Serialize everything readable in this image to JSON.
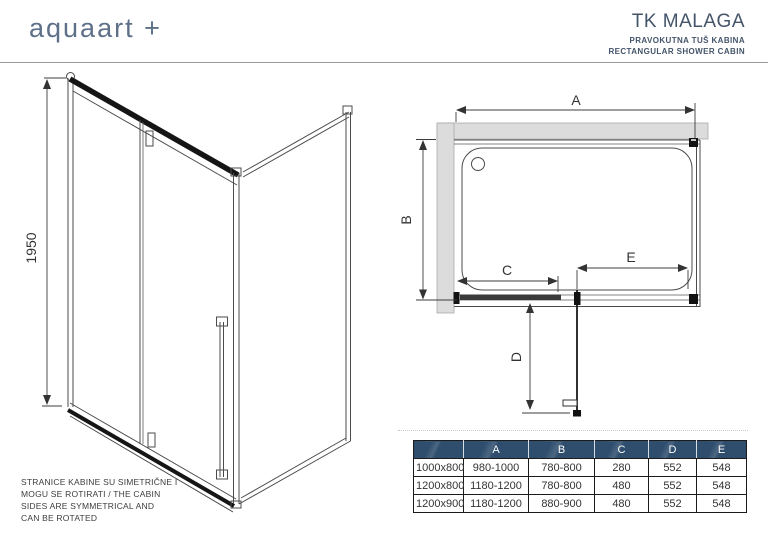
{
  "header": {
    "logo": "aquaart +",
    "product_name": "TK MALAGA",
    "subtitle_hr": "PRAVOKUTNA TUŠ KABINA",
    "subtitle_en": "RECTANGULAR SHOWER CABIN"
  },
  "elevation": {
    "height_label": "1950",
    "note": "STRANICE KABINE SU SIMETRIČNE I\nMOGU SE ROTIRATI / THE CABIN\nSIDES ARE SYMMETRICAL AND\nCAN BE ROTATED"
  },
  "plan": {
    "dim_a": "A",
    "dim_b": "B",
    "dim_c": "C",
    "dim_d": "D",
    "dim_e": "E"
  },
  "size_table": {
    "columns": [
      "",
      "A",
      "B",
      "C",
      "D",
      "E"
    ],
    "rows": [
      {
        "size": "1000x800",
        "a": "980-1000",
        "b": "780-800",
        "c": "280",
        "d": "552",
        "e": "548"
      },
      {
        "size": "1200x800",
        "a": "1180-1200",
        "b": "780-800",
        "c": "480",
        "d": "552",
        "e": "548"
      },
      {
        "size": "1200x900",
        "a": "1180-1200",
        "b": "880-900",
        "c": "480",
        "d": "552",
        "e": "548"
      }
    ]
  },
  "colors": {
    "brand": "#5e7088",
    "title": "#44546a",
    "table_header": "#2f4e6e",
    "wall_gray": "#dcdcdc",
    "line": "#4b4b4b"
  }
}
